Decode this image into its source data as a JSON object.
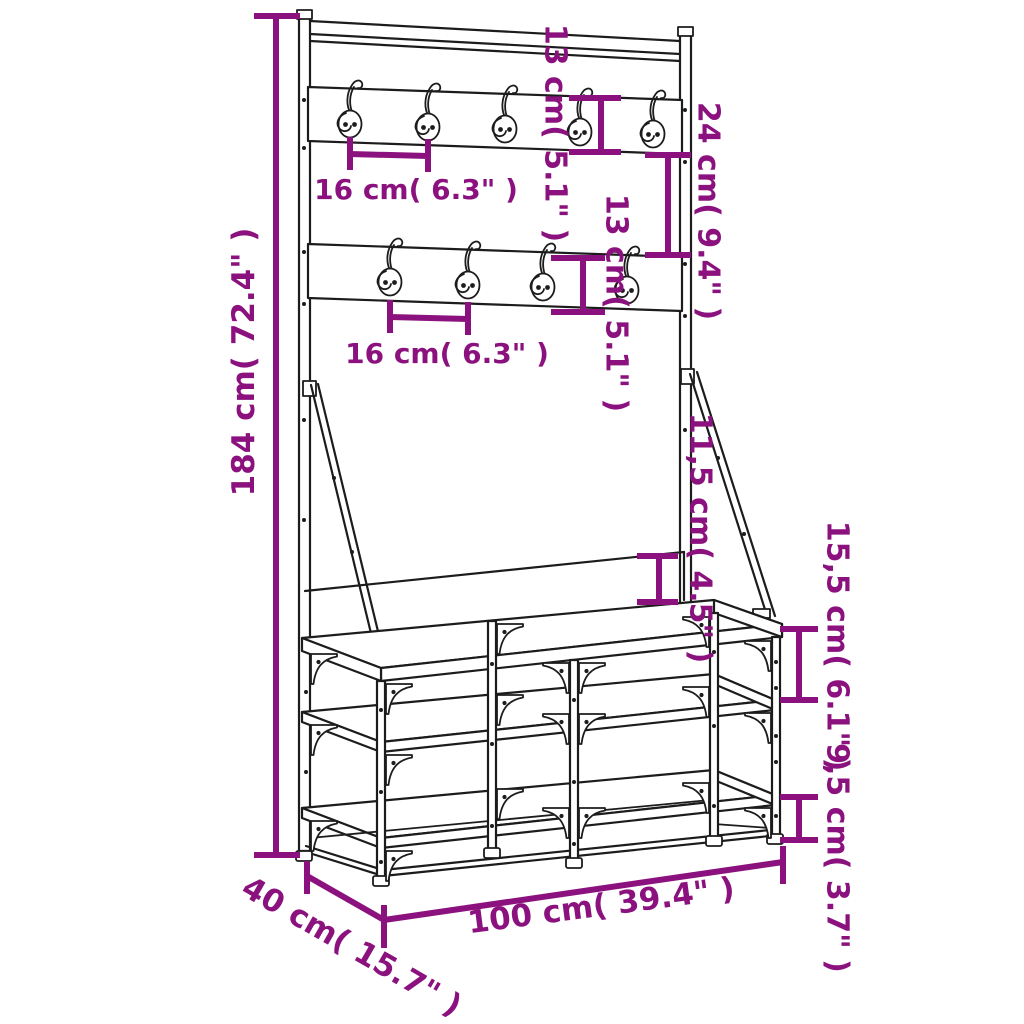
{
  "diagram": {
    "colors": {
      "dimension": "#8B127E",
      "line": "#1C1C1C",
      "background": "#FFFFFF"
    },
    "labels": {
      "total_height": "184 cm( 72.4\" )",
      "hook_spacing_top": "16 cm( 6.3\" )",
      "hook_spacing_bottom": "16 cm( 6.3\" )",
      "top_rail_height": "13 cm( 5.1\" )",
      "rail_gap": "24 cm( 9.4\" )",
      "bottom_rail_height": "13 cm( 5.1\" )",
      "backrest_height": "11,5 cm( 4.5\" )",
      "seat_to_shelf": "15,5 cm( 6.1\" )",
      "shelf_to_floor": "9,5 cm( 3.7\" )",
      "width": "100 cm( 39.4\" )",
      "depth": "40 cm( 15.7\" )"
    }
  }
}
